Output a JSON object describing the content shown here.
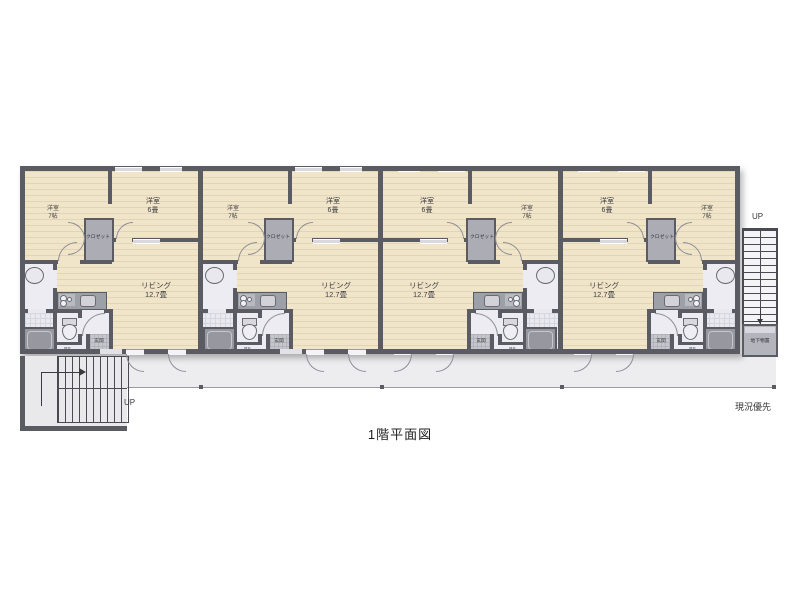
{
  "title": "1階平面図",
  "note": "現況優先",
  "stairs": {
    "left_up_label": "UP",
    "right_up_label": "UP",
    "basement_storage_label": "地下物置"
  },
  "colors": {
    "wall": "#5b5b63",
    "floor_wood": "#f1e5c9",
    "floor_light": "#ececf2",
    "closet": "#acacb4",
    "corridor": "#ededef"
  },
  "units": [
    {
      "id": 1,
      "mirrored": false,
      "bedroom_small": {
        "name": "洋室",
        "size": "7帖"
      },
      "bedroom_large": {
        "name": "洋室",
        "size": "6畳"
      },
      "closet_label": "クロゼット",
      "living": {
        "name": "リビング",
        "size": "12.7畳"
      },
      "entrance_label": "玄関",
      "ps_label": "PS"
    },
    {
      "id": 2,
      "mirrored": false,
      "bedroom_small": {
        "name": "洋室",
        "size": "7帖"
      },
      "bedroom_large": {
        "name": "洋室",
        "size": "6畳"
      },
      "closet_label": "クロゼット",
      "living": {
        "name": "リビング",
        "size": "12.7畳"
      },
      "entrance_label": "玄関",
      "ps_label": "PS"
    },
    {
      "id": 3,
      "mirrored": true,
      "bedroom_small": {
        "name": "洋室",
        "size": "7帖"
      },
      "bedroom_large": {
        "name": "洋室",
        "size": "6畳"
      },
      "closet_label": "クロゼット",
      "living": {
        "name": "リビング",
        "size": "12.7畳"
      },
      "entrance_label": "玄関",
      "ps_label": "PS"
    },
    {
      "id": 4,
      "mirrored": true,
      "bedroom_small": {
        "name": "洋室",
        "size": "7帖"
      },
      "bedroom_large": {
        "name": "洋室",
        "size": "6畳"
      },
      "closet_label": "クロゼット",
      "living": {
        "name": "リビング",
        "size": "12.7畳"
      },
      "entrance_label": "玄関",
      "ps_label": "PS"
    }
  ]
}
